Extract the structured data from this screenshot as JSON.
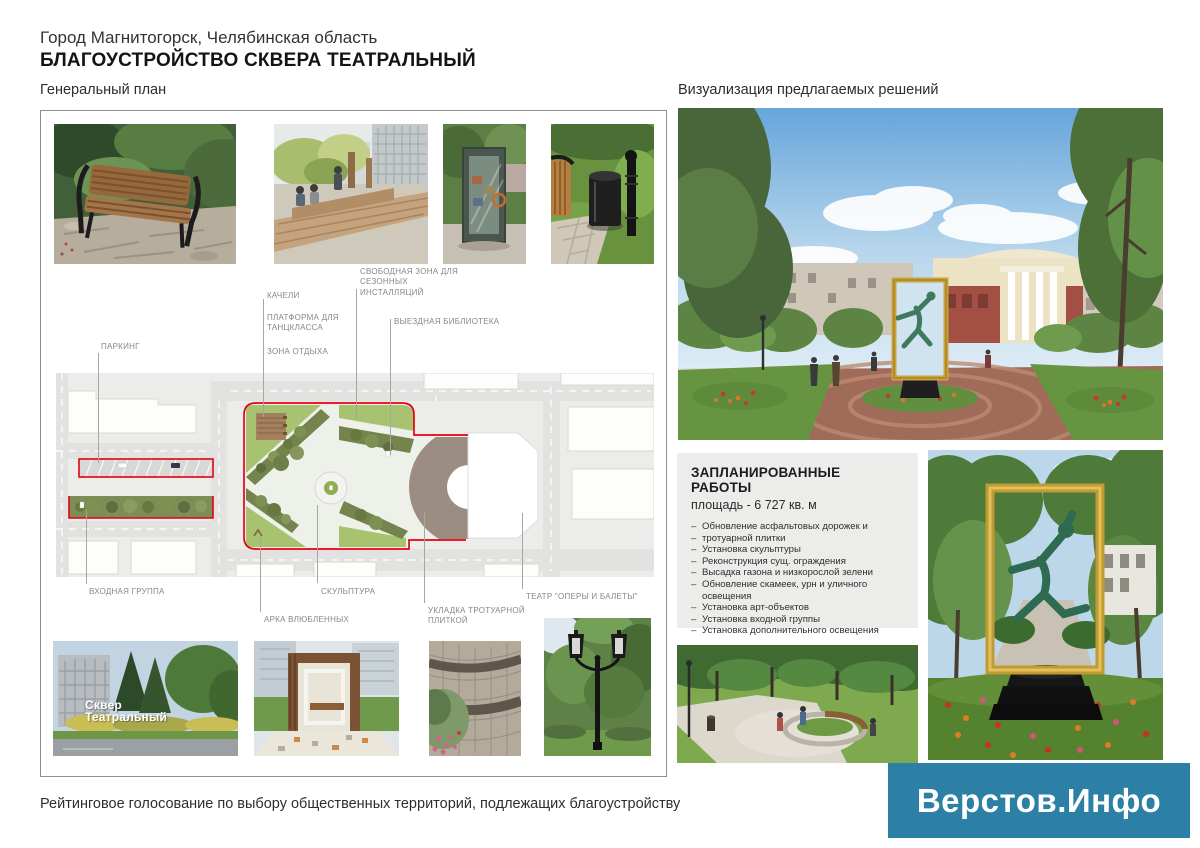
{
  "page": {
    "title_line1": "Город Магнитогорск, Челябинская область",
    "title_line2": "БЛАГОУСТРОЙСТВО СКВЕРА ТЕАТРАЛЬНЫЙ",
    "footer": "Рейтинговое голосование по выбору общественных территорий, подлежащих благоустройству"
  },
  "left_panel": {
    "heading": "Генеральный план",
    "plan_labels": {
      "parking": "ПАРКИНГ",
      "swings": "КАЧЕЛИ",
      "platform": "ПЛАТФОРМА ДЛЯ ТАНЦКЛАССА",
      "rest": "ЗОНА ОТДЫХА",
      "free_zone": "СВОБОДНАЯ ЗОНА ДЛЯ СЕЗОННЫХ ИНСТАЛЛЯЦИЙ",
      "library": "ВЫЕЗДНАЯ БИБЛИОТЕКА",
      "entrance": "ВХОДНАЯ ГРУППА",
      "sculpture": "СКУЛЬПТУРА",
      "arch": "АРКА ВЛЮБЛЕННЫХ",
      "paving": "УКЛАДКА ТРОТУАРНОЙ ПЛИТКОЙ",
      "theater": "ТЕАТР \"ОПЕРЫ И БАЛЕТЫ\""
    },
    "sign_photo": {
      "line1": "Сквер",
      "line2": "Театральный"
    }
  },
  "right_panel": {
    "heading": "Визуализация предлагаемых решений",
    "works": {
      "title": "ЗАПЛАНИРОВАННЫЕ РАБОТЫ",
      "subtitle": "площадь - 6 727 кв. м",
      "items": [
        "Обновление асфальтовых дорожек и",
        "тротуарной плитки",
        "Установка скульптуры",
        "Реконструкция сущ. ограждения",
        "Высадка газона и низкорослой зелени",
        "Обновление скамеек, урн и уличного освещения",
        "Установка арт-объектов",
        "Установка входной группы",
        "Установка дополнительного освещения"
      ]
    }
  },
  "logo": {
    "text": "Верстов.Инфо",
    "background": "#2c80a5"
  },
  "colors": {
    "boundary_red": "#e60014",
    "lawn_green": "#a7c36f",
    "plaza_brown": "#9c8d83",
    "logo_teal": "#2c80a5"
  }
}
